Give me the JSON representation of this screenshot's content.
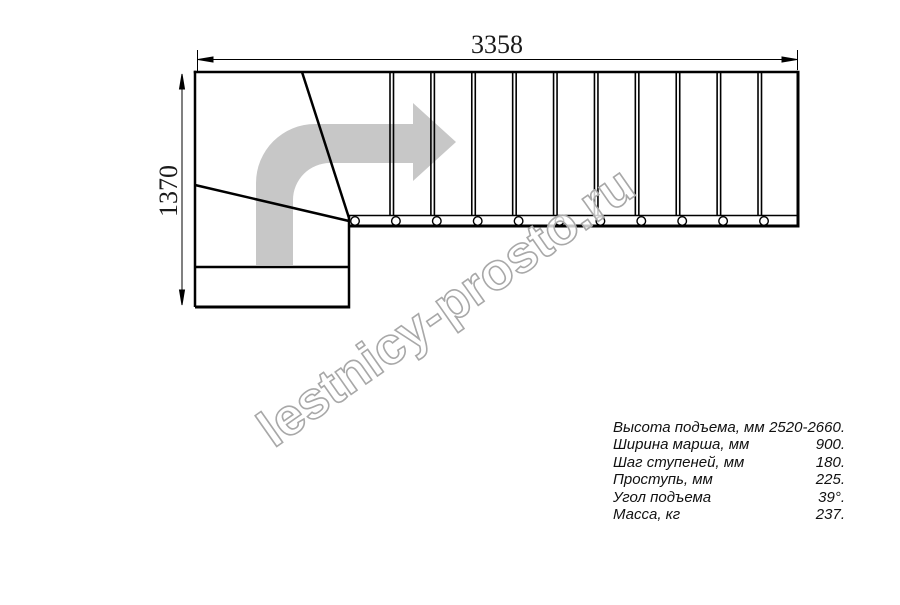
{
  "drawing_title": "stair-plan",
  "dimensions": {
    "top_width_mm": "3358",
    "left_height_mm": "1370"
  },
  "watermark": "lestnicy-prosto.ru",
  "specs": {
    "rows": [
      {
        "label": "Высота подъема, мм",
        "value": "2520-2660."
      },
      {
        "label": "Ширина марша, мм",
        "value": "900."
      },
      {
        "label": "Шаг ступеней, мм",
        "value": "180."
      },
      {
        "label": "Проступь, мм",
        "value": "225."
      },
      {
        "label": "Угол подъема",
        "value": "39°."
      },
      {
        "label": "Масса, кг",
        "value": "237."
      }
    ]
  },
  "drawing": {
    "tread_separator_count": 10,
    "bolt_circle_count": 11,
    "colors": {
      "line": "#000000",
      "direction_arrow": "#c7c7c7",
      "watermark_outline": "#a8a8a8"
    }
  }
}
